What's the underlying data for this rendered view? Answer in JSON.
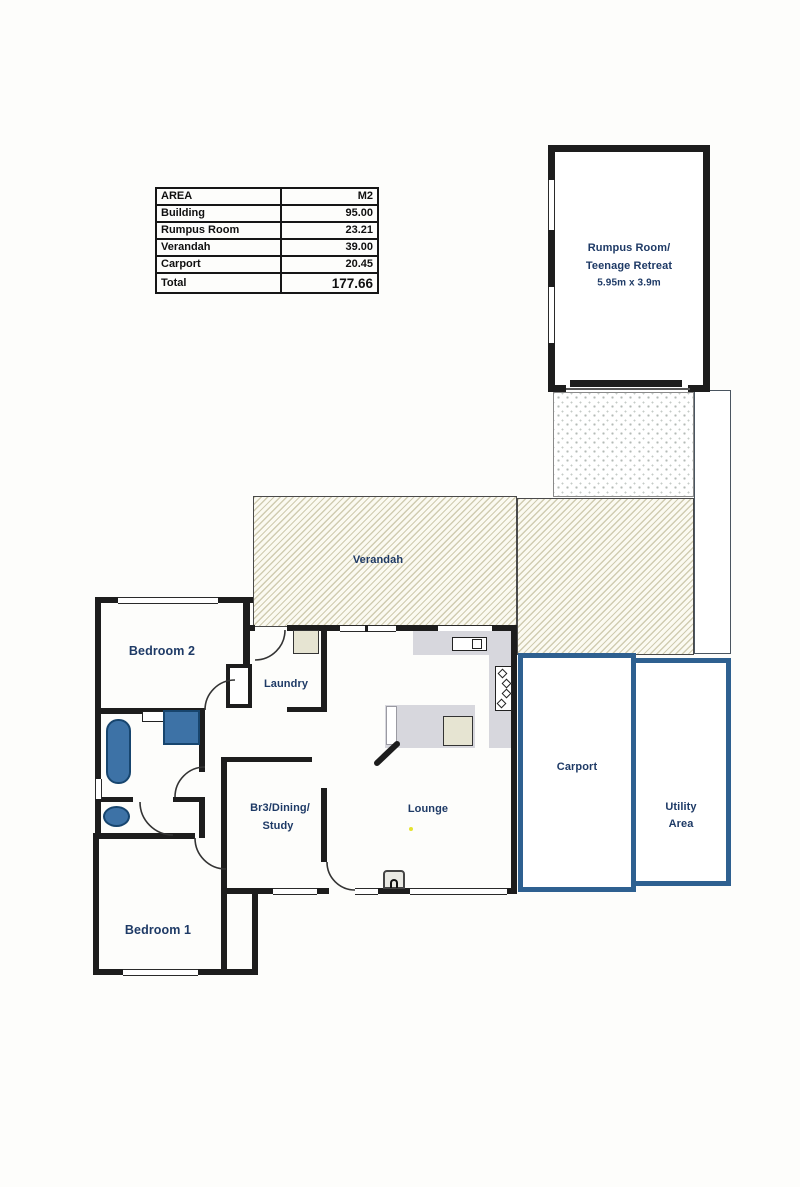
{
  "area_table": {
    "headers": {
      "area": "AREA",
      "unit": "M2"
    },
    "rows": [
      {
        "label": "Building",
        "value": "95.00"
      },
      {
        "label": "Rumpus Room",
        "value": "23.21"
      },
      {
        "label": "Verandah",
        "value": "39.00"
      },
      {
        "label": "Carport",
        "value": "20.45"
      }
    ],
    "total": {
      "label": "Total",
      "value": "177.66"
    }
  },
  "rooms": {
    "rumpus_line1": "Rumpus Room/",
    "rumpus_line2": "Teenage Retreat",
    "rumpus_dims": "5.95m x 3.9m",
    "verandah": "Verandah",
    "bedroom2": "Bedroom 2",
    "laundry": "Laundry",
    "br3_line1": "Br3/Dining/",
    "br3_line2": "Study",
    "lounge": "Lounge",
    "carport": "Carport",
    "utility_line1": "Utility",
    "utility_line2": "Area",
    "bedroom1": "Bedroom 1"
  },
  "colors": {
    "wall": "#1d1d1d",
    "outdoor_outline_blue": "#2e6090",
    "label_navy": "#1e3a66",
    "fixture_blue": "#3d72a6",
    "fixture_border": "#17456e",
    "appliance_beige": "#e6e4d2",
    "counter_gray": "#d7d7dd",
    "hatch_tint": "#beb896"
  }
}
